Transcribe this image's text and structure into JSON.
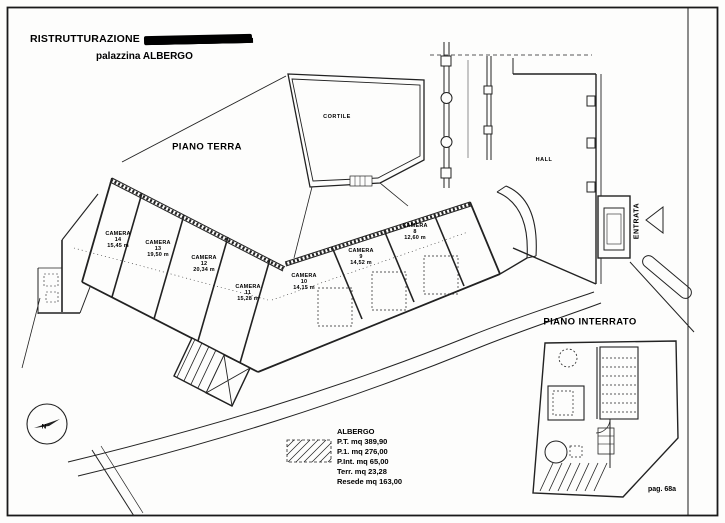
{
  "title": {
    "line1": "RISTRUTTURAZIONE",
    "line2": "palazzina ALBERGO"
  },
  "plan_labels": {
    "floor_ground": "PIANO TERRA",
    "floor_basement": "PIANO INTERRATO",
    "courtyard": "CORTILE",
    "hall": "HALL",
    "entrance": "ENTRATA",
    "north": "N"
  },
  "rooms": [
    {
      "name": "CAMERA",
      "number": "14",
      "area": "15,45 m"
    },
    {
      "name": "CAMERA",
      "number": "13",
      "area": "19,50 m"
    },
    {
      "name": "CAMERA",
      "number": "12",
      "area": "20,34 m"
    },
    {
      "name": "CAMERA",
      "number": "11",
      "area": "15,28 m"
    },
    {
      "name": "CAMERA",
      "number": "10",
      "area": "14,15 m"
    },
    {
      "name": "CAMERA",
      "number": "9",
      "area": "14,52 m"
    },
    {
      "name": "CAMERA",
      "number": "8",
      "area": "12,60 m"
    }
  ],
  "legend": {
    "title": "ALBERGO",
    "items": [
      "P.T. mq 389,90",
      "P.1. mq 276,00",
      "P.Int. mq 65,00",
      "Terr. mq 23,28",
      "Resede mq 163,00"
    ]
  },
  "page": {
    "number": "pag. 68a"
  }
}
